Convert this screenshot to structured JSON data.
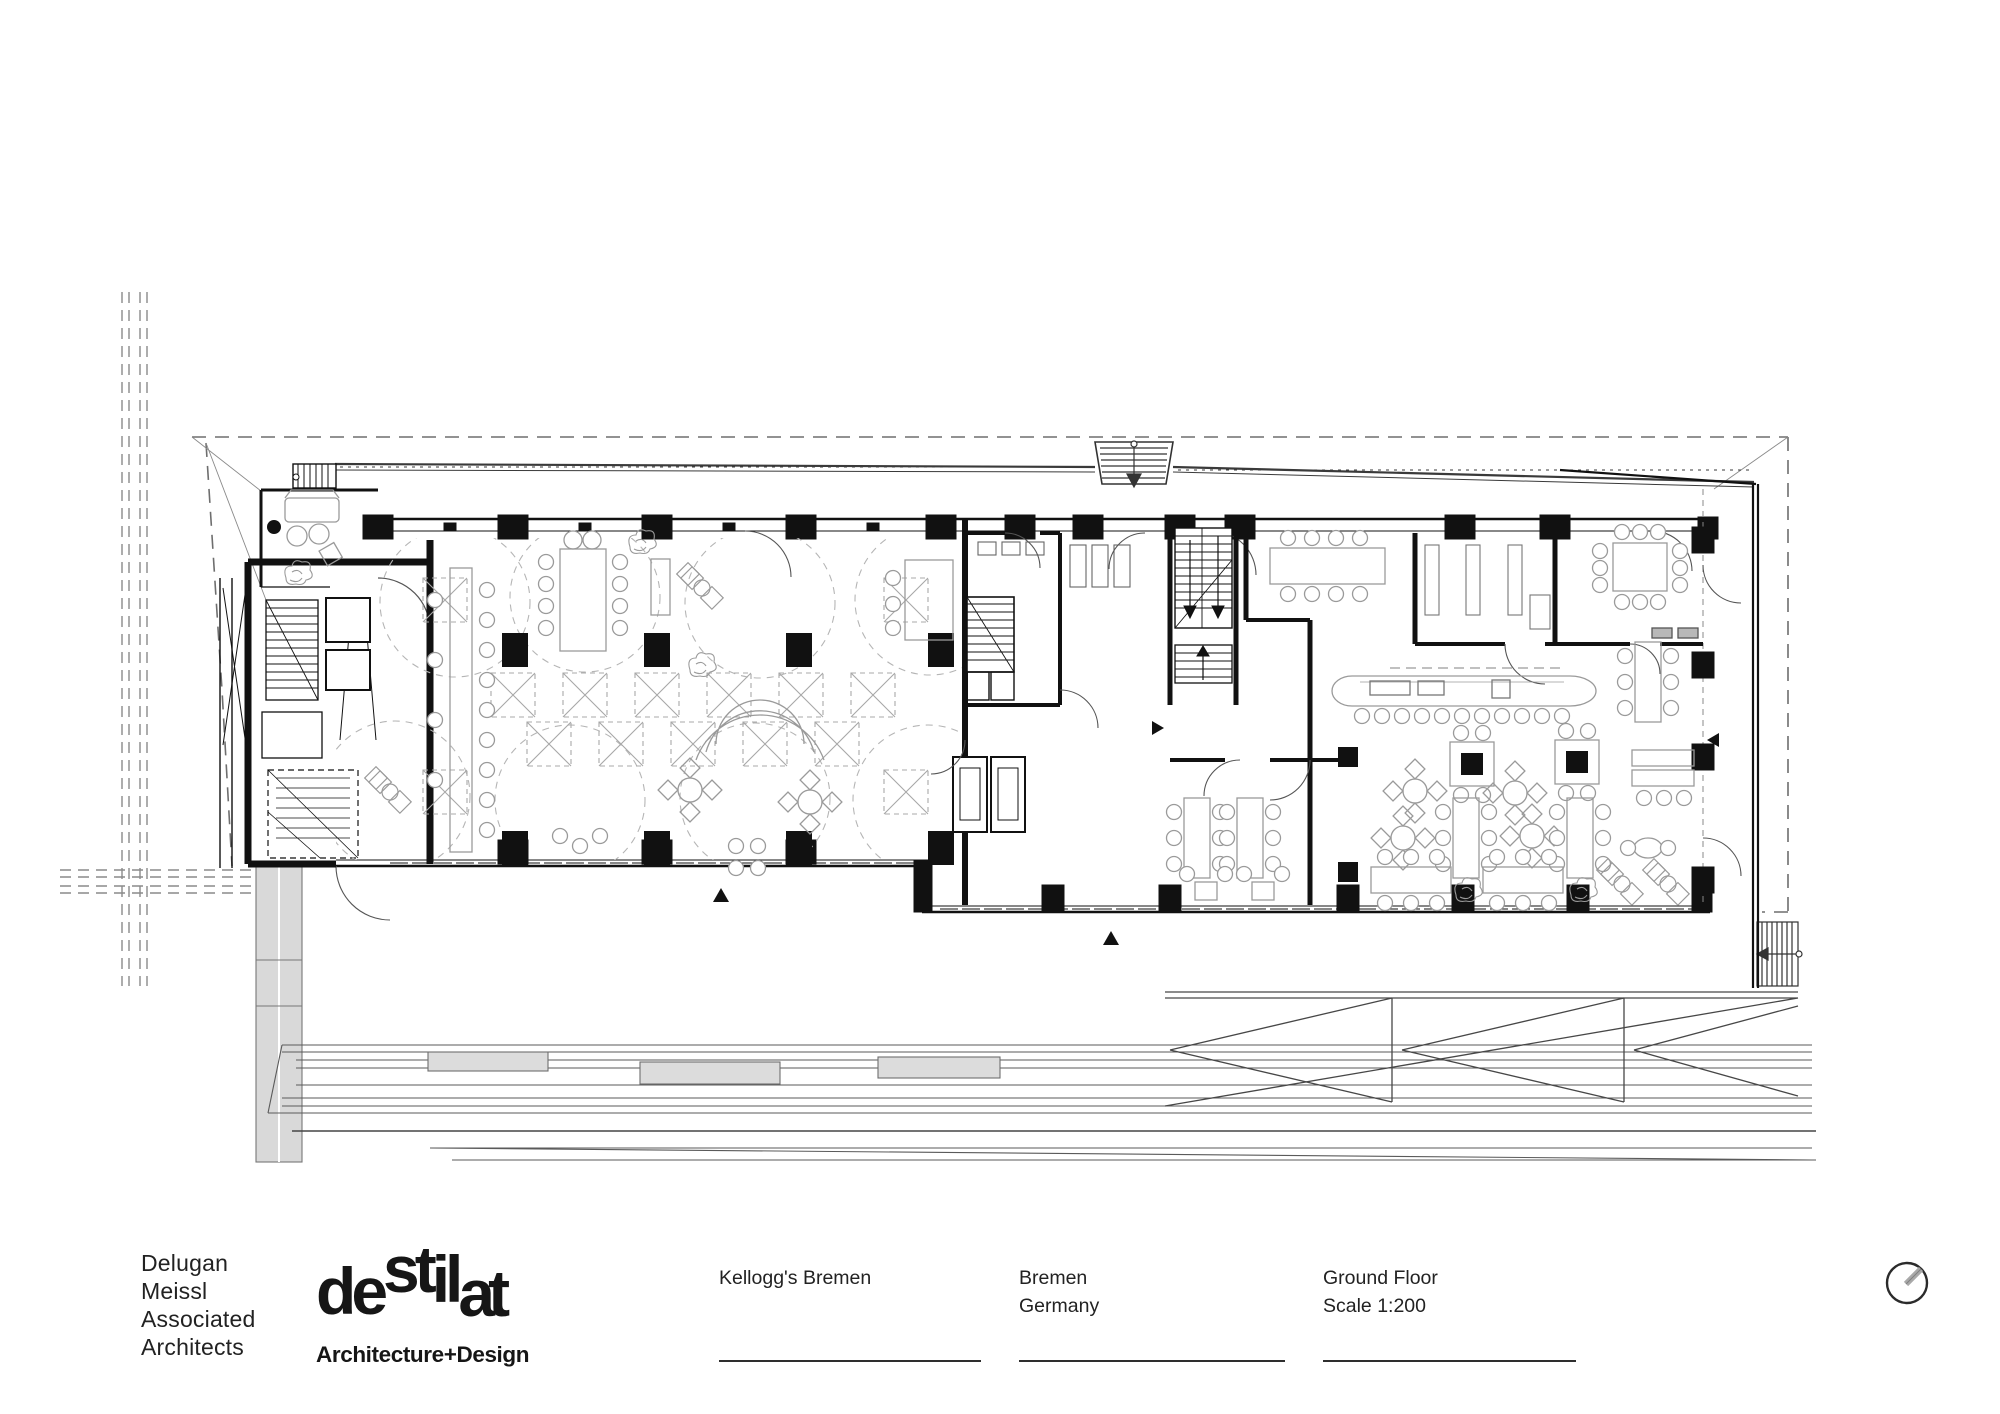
{
  "sheet": {
    "kind": "architectural drawing sheet",
    "background": "#ffffff",
    "ink_color": "#1a1a1a",
    "furniture_color": "#9a9a9a",
    "site_line_color": "#6e6e6e",
    "light_fill": "#d9d9d9"
  },
  "title_block": {
    "architect_lines": [
      "Delugan",
      "Meissl",
      "Associated",
      "Architects"
    ],
    "studio_logo_de": "de",
    "studio_logo_st": "st",
    "studio_logo_il": "il",
    "studio_logo_at": "at",
    "studio_tagline": "Architecture+Design",
    "project_name": "Kellogg's Bremen",
    "location_city": "Bremen",
    "location_country": "Germany",
    "drawing_floor": "Ground Floor",
    "drawing_scale": "Scale 1:200"
  },
  "plan": {
    "content": "Ground floor plan of Kellogg's Bremen: left wing with circular meeting areas and coffered ceiling squares, central stair/elevator core, right wing canteen with serving counter and dining tables, south boardwalk terrace with ramp",
    "icons": {
      "north_indicator": "circle-with-diagonal-tick",
      "entrance_markers": "solid black triangles"
    }
  }
}
